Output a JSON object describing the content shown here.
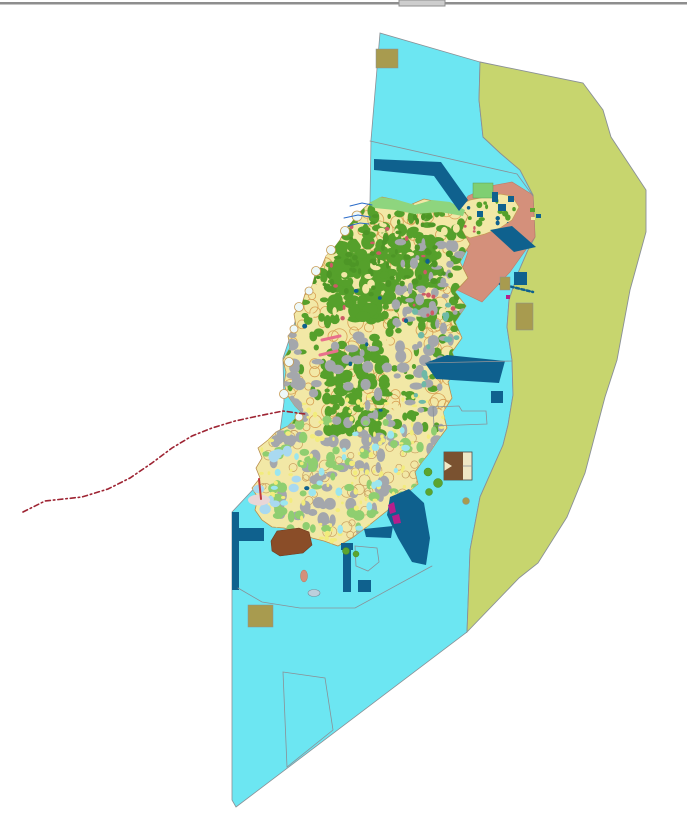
{
  "map": {
    "background": "#FFFFFF",
    "texture_seed": 20,
    "ops": [
      {
        "kind": "rect",
        "name": "window-divider-line",
        "x": 0,
        "y": 2,
        "w": 687,
        "h": 2.5,
        "fill": "#8E8E8E"
      },
      {
        "kind": "rect",
        "name": "window-divider-handle",
        "x": 399,
        "y": 0,
        "w": 46,
        "h": 6,
        "fill": "#CDCDCD",
        "stroke": "#8E8E8E",
        "sw": 1,
        "interactable": "true"
      },
      {
        "kind": "polygon",
        "name": "sea-zone",
        "points": "380,33 480,62 479,100 483,137 500,153 520,170 533,195 535,237 528,250 518,273 509,300 507,327 512,360 513,395 508,425 503,445 480,497 470,550 467,632 236,807 232,800 232,512 262,480 278,446 284,402 283,358 299,310 329,256 352,225 370,203 371,140",
        "fill": "#6CE6F2",
        "stroke": "#8A9096",
        "sw": 0.8
      },
      {
        "kind": "polygon",
        "name": "offshore-zone",
        "points": "480,62 583,83 603,110 611,137 646,190 646,232 630,290 617,360 605,397 585,473 567,517 538,563 519,578 467,632 470,550 480,497 503,445 508,425 513,395 512,360 507,327 509,300 518,273 528,250 535,237 533,195 520,170 500,153 483,137 479,100",
        "fill": "#C7D56E",
        "stroke": "#8A9096",
        "sw": 0.9
      },
      {
        "kind": "polygon",
        "name": "coastal-strip-zone",
        "points": "468,196 490,186 512,182 533,195 535,237 510,272 482,302 455,289 468,252 452,233 459,213",
        "fill": "#D4907B",
        "stroke": "#C07A66",
        "sw": 0.6
      },
      {
        "kind": "region",
        "name": "ne-peninsula-parcels",
        "outline": "455,207 470,200 485,197 500,194 512,196 519,207 512,220 500,228 485,234 470,238 458,232 450,220",
        "base": "#F2E8A6",
        "stroke": "#C79B54",
        "sw": 0.7,
        "layers": [
          {
            "color": "#55A02B",
            "count": 16,
            "rmin": 1.5,
            "rmax": 3.5,
            "x0": 452,
            "y0": 198,
            "x1": 516,
            "y1": 234
          },
          {
            "color": "#0F618E",
            "count": 4,
            "rmin": 1.5,
            "rmax": 2.5,
            "x0": 455,
            "y0": 200,
            "x1": 514,
            "y1": 232
          },
          {
            "color": "#CD5A66",
            "count": 5,
            "rmin": 1,
            "rmax": 2,
            "x0": 455,
            "y0": 200,
            "x1": 514,
            "y1": 232
          }
        ]
      },
      {
        "kind": "rect",
        "name": "green-field-ne",
        "x": 473,
        "y": 183,
        "w": 20,
        "h": 15,
        "fill": "#7FCF72",
        "stroke": "#5E9E55",
        "sw": 0.5
      },
      {
        "kind": "region",
        "name": "island-parcels",
        "outline": "370,203 382,197 396,200 410,205 424,199 438,202 452,204 462,210 468,216 462,230 470,244 460,262 468,278 455,292 466,306 455,322 462,338 452,352 458,368 448,382 452,398 443,412 447,428 438,440 430,452 422,462 415,472 418,484 408,492 398,500 388,510 378,518 368,526 352,538 338,546 324,541 312,538 298,532 284,528 272,527 262,520 255,510 258,498 252,488 260,478 256,468 262,458 258,448 268,440 276,432 288,426 296,418 303,414 295,406 288,396 284,384 286,372 283,360 290,348 288,336 296,326 294,314 302,304 305,294 312,286 315,275 322,266 326,256 334,248 340,240 345,230 352,222 358,214 364,208",
        "base": "#F2E8A6",
        "stroke": "#B98F4E",
        "sw": 0.8,
        "layers": [
          {
            "shape": "ring",
            "stroke": "#D8A155",
            "sw": 0.8,
            "count": 150,
            "rmin": 3,
            "rmax": 8,
            "x0": 290,
            "y0": 205,
            "x1": 468,
            "y1": 430
          },
          {
            "shape": "ring",
            "stroke": "#C9A061",
            "sw": 0.7,
            "count": 60,
            "rmin": 3,
            "rmax": 6,
            "x0": 262,
            "y0": 430,
            "x1": 430,
            "y1": 542
          },
          {
            "color": "#55A02B",
            "count": 150,
            "rmin": 2.5,
            "rmax": 7,
            "x0": 300,
            "y0": 210,
            "x1": 465,
            "y1": 330
          },
          {
            "color": "#55A02B",
            "count": 120,
            "rmin": 3,
            "rmax": 8,
            "x0": 330,
            "y0": 240,
            "x1": 430,
            "y1": 320
          },
          {
            "color": "#F2E8A6",
            "count": 70,
            "rmin": 2,
            "rmax": 5,
            "x0": 300,
            "y0": 215,
            "x1": 460,
            "y1": 420
          },
          {
            "color": "#55A02B",
            "count": 90,
            "rmin": 3,
            "rmax": 7,
            "x0": 325,
            "y0": 350,
            "x1": 385,
            "y1": 435
          },
          {
            "color": "#55A02B",
            "count": 70,
            "rmin": 2,
            "rmax": 5.5,
            "x0": 285,
            "y0": 330,
            "x1": 455,
            "y1": 430
          },
          {
            "color": "#A4A7AC",
            "count": 150,
            "rmin": 2.5,
            "rmax": 7,
            "x0": 270,
            "y0": 330,
            "x1": 455,
            "y1": 540
          },
          {
            "color": "#A4A7AC",
            "count": 45,
            "rmin": 2,
            "rmax": 6,
            "x0": 395,
            "y0": 240,
            "x1": 465,
            "y1": 330
          },
          {
            "color": "#8FCE70",
            "count": 70,
            "rmin": 2.5,
            "rmax": 6,
            "x0": 265,
            "y0": 420,
            "x1": 440,
            "y1": 540
          },
          {
            "color": "#F2EC7C",
            "count": 130,
            "rmin": 1.2,
            "rmax": 3,
            "x0": 260,
            "y0": 395,
            "x1": 445,
            "y1": 543
          },
          {
            "color": "#6FB9A7",
            "count": 22,
            "rmin": 2,
            "rmax": 4.5,
            "x0": 415,
            "y0": 300,
            "x1": 465,
            "y1": 420
          },
          {
            "color": "#9BE6EF",
            "count": 26,
            "rmin": 2,
            "rmax": 4.5,
            "x0": 265,
            "y0": 430,
            "x1": 430,
            "y1": 540
          },
          {
            "color": "#A9D9F0",
            "count": 12,
            "rmin": 3,
            "rmax": 6,
            "x0": 255,
            "y0": 448,
            "x1": 300,
            "y1": 512
          },
          {
            "color": "#4D9626",
            "count": 80,
            "rmin": 1.5,
            "rmax": 4,
            "x0": 305,
            "y0": 215,
            "x1": 460,
            "y1": 300
          },
          {
            "color": "#CD5A66",
            "count": 22,
            "rmin": 1.2,
            "rmax": 2.6,
            "x0": 310,
            "y0": 210,
            "x1": 460,
            "y1": 320
          },
          {
            "color": "#0F618E",
            "count": 10,
            "rmin": 1.5,
            "rmax": 3,
            "x0": 300,
            "y0": 240,
            "x1": 450,
            "y1": 520
          }
        ]
      },
      {
        "kind": "circles",
        "name": "coastal-bays",
        "fill": "#EDF8F9",
        "stroke": "#C79B54",
        "sw": 0.8,
        "items": [
          [
            357,
            216,
            5
          ],
          [
            345,
            231,
            4.5
          ],
          [
            331,
            250,
            4.5
          ],
          [
            316,
            271,
            4.5
          ],
          [
            309,
            291,
            4
          ],
          [
            299,
            307,
            4.5
          ],
          [
            294,
            329,
            4
          ],
          [
            289,
            362,
            4.5
          ],
          [
            284,
            394,
            4.5
          ],
          [
            299,
            417,
            4
          ]
        ]
      },
      {
        "kind": "polygon",
        "name": "north-shore-greenbelt",
        "points": "368,204 380,197 398,200 415,205 432,200 450,202 465,210 463,216 440,212 415,214 395,210 375,208",
        "fill": "#8ED57E"
      },
      {
        "kind": "polygon",
        "name": "harbor-channel-north",
        "points": "374,159 441,162 468,200 459,211 434,176 374,170",
        "fill": "#0F618E"
      },
      {
        "kind": "polygon",
        "name": "harbor-diagonal-ne",
        "points": "490,230 512,226 536,247 514,252",
        "fill": "#0F618E"
      },
      {
        "kind": "rect",
        "name": "teal-square-ne",
        "x": 492,
        "y": 192,
        "w": 6,
        "h": 10,
        "fill": "#0F618E"
      },
      {
        "kind": "polygon",
        "name": "harbor-basin-east",
        "points": "425,363 447,355 505,361 499,383 436,379",
        "fill": "#0F618E"
      },
      {
        "kind": "rect",
        "name": "navy-square-east",
        "x": 491,
        "y": 391,
        "w": 12,
        "h": 12,
        "fill": "#0F618E"
      },
      {
        "kind": "polygon",
        "name": "harbor-bay-southeast",
        "points": "390,497 409,489 424,503 430,538 426,565 412,562 398,538 387,515",
        "fill": "#0F618E"
      },
      {
        "kind": "polygon",
        "name": "navy-strip-south-coast",
        "points": "364,529 393,526 391,538 366,537",
        "fill": "#0F618E"
      },
      {
        "kind": "rect",
        "name": "navy-pier-west",
        "x": 232,
        "y": 512,
        "w": 7,
        "h": 78,
        "fill": "#0F618E"
      },
      {
        "kind": "rect",
        "name": "navy-pier-west-arm",
        "x": 239,
        "y": 528,
        "w": 25,
        "h": 13,
        "fill": "#0F618E"
      },
      {
        "kind": "rect",
        "name": "navy-bar-south",
        "x": 343,
        "y": 543,
        "w": 8,
        "h": 49,
        "fill": "#0F618E"
      },
      {
        "kind": "rect",
        "name": "navy-bar-south-cap",
        "x": 341,
        "y": 543,
        "w": 12,
        "h": 7,
        "fill": "#0F618E"
      },
      {
        "kind": "rect",
        "name": "navy-square-south",
        "x": 358,
        "y": 580,
        "w": 13,
        "h": 12,
        "fill": "#0F618E"
      },
      {
        "kind": "rect",
        "name": "navy-square-offshore",
        "x": 514,
        "y": 272,
        "w": 13,
        "h": 13,
        "fill": "#0F618E"
      },
      {
        "kind": "rects",
        "name": "navy-bits-ne-tip",
        "items": [
          [
            498,
            204,
            8,
            7,
            "#0F618E"
          ],
          [
            477,
            211,
            6,
            6,
            "#0F618E"
          ],
          [
            508,
            196,
            6,
            6,
            "#0F618E"
          ]
        ]
      },
      {
        "kind": "polyline",
        "name": "mooring-chain-line",
        "points": "500,284 533,292",
        "stroke": "#0F618E",
        "sw": 2.5,
        "dash": "3 2.5"
      },
      {
        "kind": "polyline",
        "name": "boundary-line-north",
        "points": "370,141 517,174 533,196",
        "stroke": "#8A9096",
        "sw": 0.8
      },
      {
        "kind": "polyline",
        "name": "boundary-line-east",
        "points": "425,363 512,361",
        "stroke": "#8A9096",
        "sw": 0.8
      },
      {
        "kind": "polyline",
        "name": "boundary-line-south",
        "points": "238,588 262,602 300,608 355,608 432,566",
        "stroke": "#8A9096",
        "sw": 0.8
      },
      {
        "kind": "polygon",
        "name": "boundary-parcel-south",
        "points": "283,672 325,678 333,730 287,767",
        "fill": "none",
        "stroke": "#8A9096",
        "sw": 0.8
      },
      {
        "kind": "polygon",
        "name": "boundary-parcel-southeast",
        "points": "433,407 459,406 462,411 486,411 487,424 434,426",
        "fill": "none",
        "stroke": "#8A9096",
        "sw": 0.8
      },
      {
        "kind": "polygon",
        "name": "boundary-parcel-harbor",
        "points": "355,546 377,548 379,562 368,571 356,566",
        "fill": "none",
        "stroke": "#8A9096",
        "sw": 0.8
      },
      {
        "kind": "rect",
        "name": "khaki-block-north",
        "x": 376,
        "y": 49,
        "w": 22,
        "h": 19,
        "fill": "#A89B4F",
        "stroke": "#8A9096",
        "sw": 0.5
      },
      {
        "kind": "rect",
        "name": "khaki-block-east",
        "x": 516,
        "y": 303,
        "w": 17,
        "h": 27,
        "fill": "#A89B4F",
        "stroke": "#8A9096",
        "sw": 0.5
      },
      {
        "kind": "rect",
        "name": "khaki-block-east-small",
        "x": 500,
        "y": 277,
        "w": 10,
        "h": 13,
        "fill": "#A89B4F",
        "stroke": "#8A9096",
        "sw": 0.5
      },
      {
        "kind": "rect",
        "name": "khaki-block-south",
        "x": 248,
        "y": 605,
        "w": 25,
        "h": 22,
        "fill": "#A89B4F",
        "stroke": "#8A9096",
        "sw": 0.5
      },
      {
        "kind": "circles",
        "name": "khaki-dot-southeast",
        "fill": "#A89B4F",
        "stroke": "#8A9096",
        "sw": 0.5,
        "items": [
          [
            466,
            501,
            3.5
          ]
        ]
      },
      {
        "kind": "polygon",
        "name": "brown-landmark-south",
        "points": "271,541 277,531 299,528 309,532 312,545 303,553 280,556 272,551",
        "fill": "#8A4D28",
        "stroke": "#6B3A1E",
        "sw": 0.6
      },
      {
        "kind": "rect",
        "name": "facility-block-east",
        "x": 444,
        "y": 452,
        "w": 28,
        "h": 28,
        "fill": "#EFE7C5",
        "stroke": "#4A4A4A",
        "sw": 0.8
      },
      {
        "kind": "polygon",
        "name": "facility-block-east-brown",
        "points": "444,452 463,452 463,480 444,480 444,471 452,466 444,461",
        "fill": "#7A5230"
      },
      {
        "kind": "polyline",
        "name": "facility-block-divider",
        "points": "463,466 472,466",
        "stroke": "#8A9096",
        "sw": 0.7
      },
      {
        "kind": "ellipse",
        "name": "salmon-islet-south",
        "cx": 304,
        "cy": 576,
        "rx": 3.5,
        "ry": 6,
        "fill": "#D4907B",
        "stroke": "#B5765F",
        "sw": 0.5
      },
      {
        "kind": "ellipse",
        "name": "pale-flat-west",
        "cx": 259,
        "cy": 500,
        "rx": 11,
        "ry": 5.5,
        "fill": "#E9D6D6"
      },
      {
        "kind": "circles",
        "name": "green-islets-east",
        "fill": "#5BA52F",
        "stroke": "#4A8A24",
        "sw": 0.5,
        "items": [
          [
            428,
            472,
            4
          ],
          [
            438,
            483,
            4.5
          ],
          [
            429,
            492,
            3.5
          ],
          [
            346,
            551,
            3.5
          ],
          [
            356,
            554,
            3
          ]
        ]
      },
      {
        "kind": "rects",
        "name": "islet-specks-ne",
        "items": [
          [
            530,
            208,
            5,
            4,
            "#5BA52F"
          ],
          [
            536,
            214,
            5,
            4,
            "#0F618E"
          ],
          [
            531,
            217,
            4,
            3,
            "#F2E8A6"
          ]
        ]
      },
      {
        "kind": "polyline",
        "name": "stream-line-1",
        "points": "350,206 362,203 372,205",
        "stroke": "#2A6BC8",
        "sw": 1
      },
      {
        "kind": "polyline",
        "name": "stream-line-2",
        "points": "344,218 358,215 370,217",
        "stroke": "#2A6BC8",
        "sw": 1
      },
      {
        "kind": "polyline",
        "name": "stream-line-3",
        "points": "348,226 360,223 369,224",
        "stroke": "#2A6BC8",
        "sw": 1
      },
      {
        "kind": "polyline",
        "name": "pink-road-1",
        "points": "322,340 340,336",
        "stroke": "#E8708C",
        "sw": 3
      },
      {
        "kind": "polyline",
        "name": "pink-road-2",
        "points": "320,355 337,351",
        "stroke": "#E8708C",
        "sw": 3
      },
      {
        "kind": "polyline",
        "name": "red-mark-west",
        "points": "259,479 261,499",
        "stroke": "#C23B3B",
        "sw": 2
      },
      {
        "kind": "polygon",
        "name": "magenta-mark-1",
        "points": "388,505 394,502 396,512 390,514",
        "fill": "#B51F8C"
      },
      {
        "kind": "polygon",
        "name": "magenta-mark-2",
        "points": "392,516 399,514 401,523 394,524",
        "fill": "#B51F8C"
      },
      {
        "kind": "rects",
        "name": "magenta-dot-east",
        "items": [
          [
            506,
            295,
            4,
            4,
            "#B51F8C"
          ]
        ]
      },
      {
        "kind": "ellipse",
        "name": "gray-islet-south",
        "cx": 314,
        "cy": 593,
        "rx": 6,
        "ry": 3.5,
        "fill": "#BCCFDC",
        "stroke": "#7A8A98",
        "sw": 0.6
      },
      {
        "kind": "polyline",
        "name": "municipal-boundary-line",
        "points": "23,512 45,501 82,497 108,489 130,478 152,463 172,448 192,436 212,428 235,421 258,416 283,411 305,414",
        "stroke": "#9E2433",
        "sw": 1.6,
        "dash": "5 3 1.5 3"
      }
    ]
  }
}
